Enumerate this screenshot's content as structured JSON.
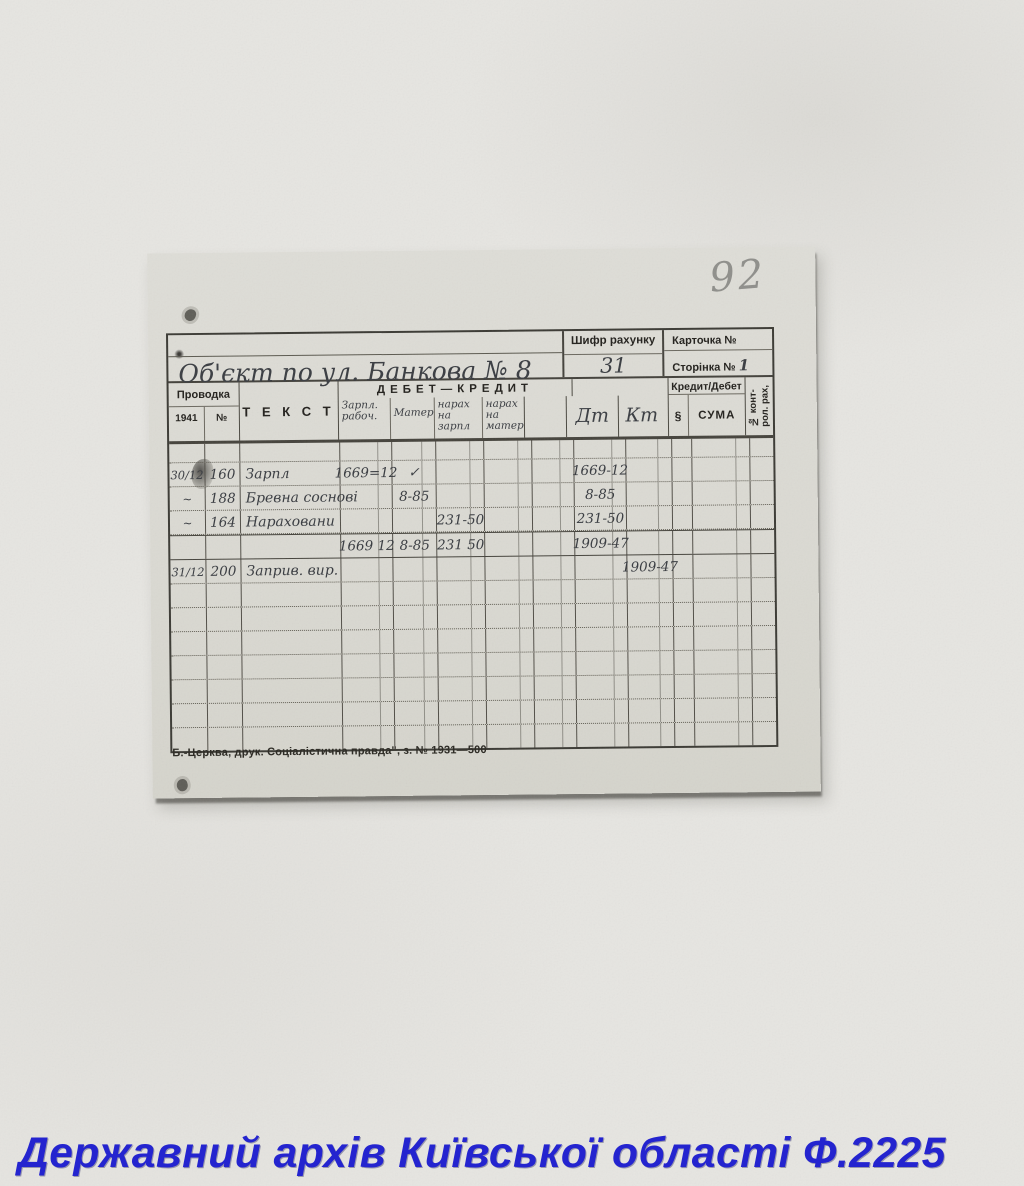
{
  "photo": {
    "pencil_number": "92",
    "caption": "Державний архів Київської області Ф.2225"
  },
  "colors": {
    "caption_blue": "#2424cf",
    "ink_gray": "#3a3d42",
    "pencil_gray": "#8f8f8b",
    "card_paper": "#dadad3"
  },
  "card": {
    "title_handwritten": "Об'єкт по ул. Банкова № 8",
    "header": {
      "account_code_label": "Шифр рахунку",
      "account_code_value": "31",
      "card_no_label": "Карточка №",
      "page_no_label": "Сторінка №",
      "page_no_value": "1"
    },
    "table": {
      "provodka_label": "Проводка",
      "year_label": "1941",
      "no_label": "№",
      "text_label": "Т Е К С Т",
      "debet_kredit_label": "ДЕБЕТ—КРЕДИТ",
      "kredit_debet_label": "Кредит/Дебет",
      "paragraph_label": "§",
      "suma_label": "СУМА",
      "control_account_label": "№ конт-\nрол. рах,",
      "handwritten_columns": [
        "Зарпл. рабоч.",
        "Матер.",
        "нарах на зарпл",
        "нарах на матер.",
        "",
        "Дт",
        "Кт"
      ],
      "rows": [
        {
          "style": "short",
          "cells": [
            "",
            "",
            "",
            "",
            "",
            "",
            "",
            "",
            "",
            "",
            "",
            "",
            ""
          ]
        },
        {
          "style": "",
          "cells": [
            "30/12",
            "160",
            "Зарпл",
            "1669=12",
            "✓",
            "",
            "",
            "",
            "1669-12",
            "",
            "",
            "",
            ""
          ]
        },
        {
          "style": "",
          "cells": [
            "~",
            "188",
            "Бревна соснові",
            "",
            "8-85",
            "",
            "",
            "",
            "8-85",
            "",
            "",
            "",
            ""
          ]
        },
        {
          "style": "",
          "cells": [
            "~",
            "164",
            "Нараховани",
            "",
            "",
            "231-50",
            "",
            "",
            "231-50",
            "",
            "",
            "",
            ""
          ]
        },
        {
          "style": "totals",
          "cells": [
            "",
            "",
            "",
            "1669 12",
            "8-85",
            "231 50",
            "",
            "",
            "1909-47",
            "",
            "",
            "",
            ""
          ]
        },
        {
          "style": "",
          "cells": [
            "31/12",
            "200",
            "Заприв. вир.",
            "",
            "",
            "",
            "",
            "",
            "",
            "1909-47",
            "",
            "",
            ""
          ]
        },
        {
          "style": "",
          "cells": [
            "",
            "",
            "",
            "",
            "",
            "",
            "",
            "",
            "",
            "",
            "",
            "",
            ""
          ]
        },
        {
          "style": "",
          "cells": [
            "",
            "",
            "",
            "",
            "",
            "",
            "",
            "",
            "",
            "",
            "",
            "",
            ""
          ]
        },
        {
          "style": "",
          "cells": [
            "",
            "",
            "",
            "",
            "",
            "",
            "",
            "",
            "",
            "",
            "",
            "",
            ""
          ]
        },
        {
          "style": "",
          "cells": [
            "",
            "",
            "",
            "",
            "",
            "",
            "",
            "",
            "",
            "",
            "",
            "",
            ""
          ]
        },
        {
          "style": "",
          "cells": [
            "",
            "",
            "",
            "",
            "",
            "",
            "",
            "",
            "",
            "",
            "",
            "",
            ""
          ]
        },
        {
          "style": "",
          "cells": [
            "",
            "",
            "",
            "",
            "",
            "",
            "",
            "",
            "",
            "",
            "",
            "",
            ""
          ]
        },
        {
          "style": "",
          "cells": [
            "",
            "",
            "",
            "",
            "",
            "",
            "",
            "",
            "",
            "",
            "",
            "",
            ""
          ]
        }
      ]
    },
    "imprint": "Б.-Церква, друк. Соціалістична правда\", з. № 1931—500"
  }
}
